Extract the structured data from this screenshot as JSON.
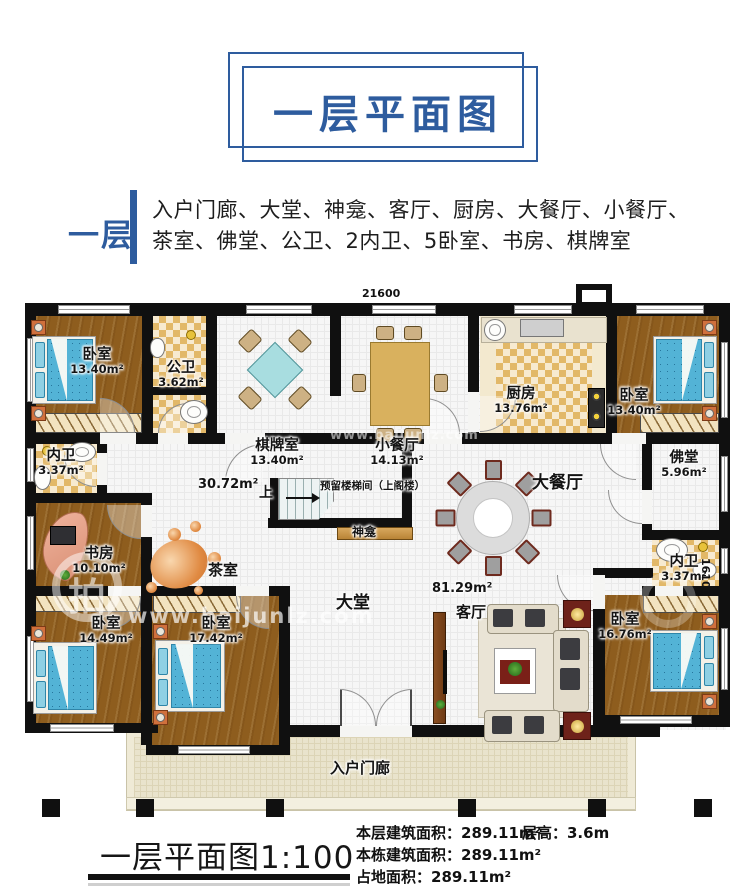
{
  "header": {
    "title": "一层平面图"
  },
  "intro": {
    "label": "一层",
    "line1": "入户门廊、大堂、神龛、客厅、厨房、大餐厅、小餐厅、",
    "line2": "茶室、佛堂、公卫、2内卫、5卧室、书房、棋牌室"
  },
  "plan": {
    "dim_top": "21600",
    "dim_right": "16100",
    "rooms": {
      "bedroom_tl": {
        "name": "卧室",
        "area": "13.40m²"
      },
      "gongwei": {
        "name": "公卫",
        "area": "3.62m²"
      },
      "qipaishi": {
        "name": "棋牌室",
        "area": "13.40m²"
      },
      "xiaocanting": {
        "name": "小餐厅",
        "area": "14.13m²"
      },
      "chufang": {
        "name": "厨房",
        "area": "13.76m²"
      },
      "bedroom_tr": {
        "name": "卧室",
        "area": "13.40m²"
      },
      "neiwei_l": {
        "name": "内卫",
        "area": "3.37m²"
      },
      "shufang": {
        "name": "书房",
        "area": "10.10m²"
      },
      "fotang": {
        "name": "佛堂",
        "area": "5.96m²"
      },
      "neiwei_r": {
        "name": "内卫",
        "area": "3.37m²"
      },
      "bedroom_bl": {
        "name": "卧室",
        "area": "14.49m²"
      },
      "bedroom_bm": {
        "name": "卧室",
        "area": "17.42m²"
      },
      "bedroom_br": {
        "name": "卧室",
        "area": "16.76m²"
      },
      "hall_area": "30.72m²",
      "datang": "大堂",
      "datang_area": "81.29m²",
      "keting": "客厅",
      "dacanting": "大餐厅",
      "chashi": "茶室",
      "shenkan": "神龛",
      "porch": "入户门廊"
    },
    "stairs": {
      "up": "上",
      "note": "预留楼梯间（上阁楼）"
    },
    "watermark": {
      "url": "www.baijunlz.com",
      "logo_char": "拍"
    }
  },
  "footer": {
    "caption": "一层平面图1:100",
    "stats": [
      "本层建筑面积：289.11m²",
      "本栋建筑面积：289.11m²",
      "占地面积：289.11m²"
    ],
    "height_note": "层高：3.6m"
  },
  "colors": {
    "accent_blue": "#2e5c9e",
    "wall_black": "#101010",
    "wood_floor": "#8e5d1e",
    "tile_tan": "#e2b868",
    "bed_blue": "#53b3d6"
  }
}
